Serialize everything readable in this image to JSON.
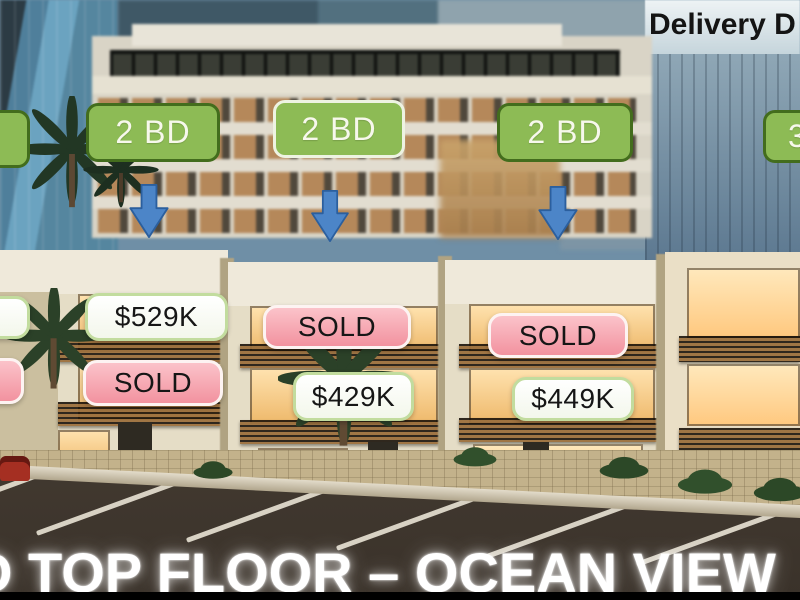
{
  "header": {
    "delivery_label": "Delivery D"
  },
  "unit_type_badges": [
    {
      "text": "2 BD"
    },
    {
      "text": "2 BD"
    },
    {
      "text": "2 BD"
    },
    {
      "text": "3"
    }
  ],
  "listings": [
    {
      "upper": "$529K",
      "lower": "SOLD"
    },
    {
      "upper": "SOLD",
      "lower": "$429K"
    },
    {
      "upper": "SOLD",
      "lower": "$449K"
    }
  ],
  "banner": {
    "text": "D TOP FLOOR – OCEAN VIEW"
  },
  "colors": {
    "badge_green": "#8dbb55",
    "badge_green_dark_border": "#436d1d",
    "badge_light_border": "#eef3e2",
    "badge_text": "#f7f8ec",
    "arrow_blue": "#4c85c8",
    "arrow_blue_border": "#2b5f9e",
    "price_white_border": "#c2dc9e",
    "sold_pink_top": "#fbc3ca",
    "sold_pink_bottom": "#f2929f",
    "sold_border": "#fdf3f2",
    "overlay_text_dark": "#161616",
    "banner_white": "#ffffff"
  }
}
